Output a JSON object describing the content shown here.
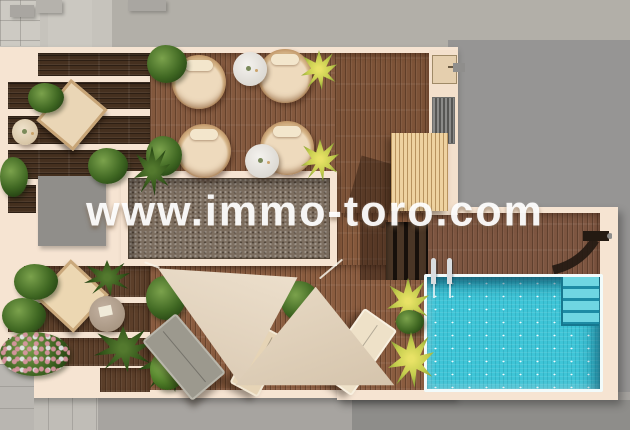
{
  "watermark": {
    "text": "www.immo-toro.com",
    "color": "#ffffff"
  },
  "scene": {
    "description": "Aerial 3D architectural render of a rooftop terrace with swimming pool",
    "inventory": {
      "wicker_armchairs": 4,
      "white_side_tables": 2,
      "sun_loungers": 3,
      "deck_chair": 1,
      "daybed": 1,
      "low_tables": 2,
      "shade_sails": 2,
      "swimming_pool": 1,
      "pool_corner_steps": 1,
      "pool_ladder": 1,
      "outdoor_shower": 1,
      "pergola_canopy": 1,
      "exterior_staircase": 1,
      "gravel_roof_sections": 1,
      "planters": "multiple green bushes, flower beds and yellow-green palms"
    }
  },
  "palette": {
    "parapet_cream": "#f6e4d2",
    "deck_dark_wood": "#45301f",
    "deck_medium_wood": "#84593e",
    "deck_light_wood": "#8a5c3f",
    "pergola_wood": "#eed2a0",
    "gravel": "#7d6f61",
    "pool_water": "#3ec5d7",
    "pool_steps": "#6fd6e2",
    "sail_fabric": "#e8d9c6",
    "roof_gray": "#b2afa8",
    "street_gray": "#a7a4a0",
    "plant_green": "#3f6722",
    "plant_yellow_green": "#c3cc4d",
    "wicker": "#b98a5b",
    "cushion_beige": "#eedabd",
    "shower_dark": "#241a12"
  }
}
